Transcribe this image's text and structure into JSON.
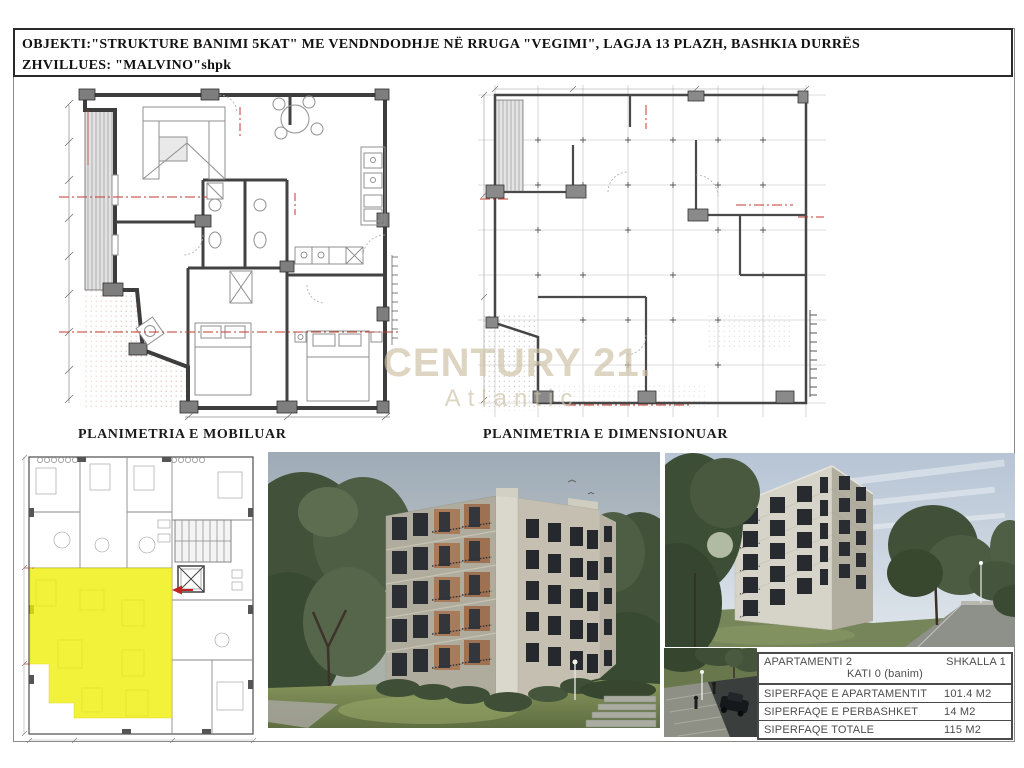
{
  "header": {
    "line1": "OBJEKTI:\"STRUKTURE BANIMI 5KAT\" ME VENDNDODHJE NË RRUGA \"VEGIMI\", LAGJA 13 PLAZH, BASHKIA DURRËS",
    "line2": "ZHVILLUES: \"MALVINO\"shpk"
  },
  "plans": {
    "furnished_label": "PLANIMETRIA E MOBILUAR",
    "dimensioned_label": "PLANIMETRIA E DIMENSIONUAR"
  },
  "watermark": {
    "brand": "CENTURY 21.",
    "sub": "Atlantic"
  },
  "info_table": {
    "apartment": "APARTAMENTI 2",
    "stair": "SHKALLA 1",
    "floor": "KATI 0 (banim)",
    "rows": [
      {
        "label": "SIPERFAQE E APARTAMENTIT",
        "value": "101.4 M2"
      },
      {
        "label": "SIPERFAQE E PERBASHKET",
        "value": "14 M2"
      },
      {
        "label": "SIPERFAQE TOTALE",
        "value": "115 M2"
      }
    ]
  },
  "colors": {
    "highlight_yellow": "#efef0a",
    "centerline_red": "#c0392b",
    "watermark_tan": "#cdc1a6"
  }
}
